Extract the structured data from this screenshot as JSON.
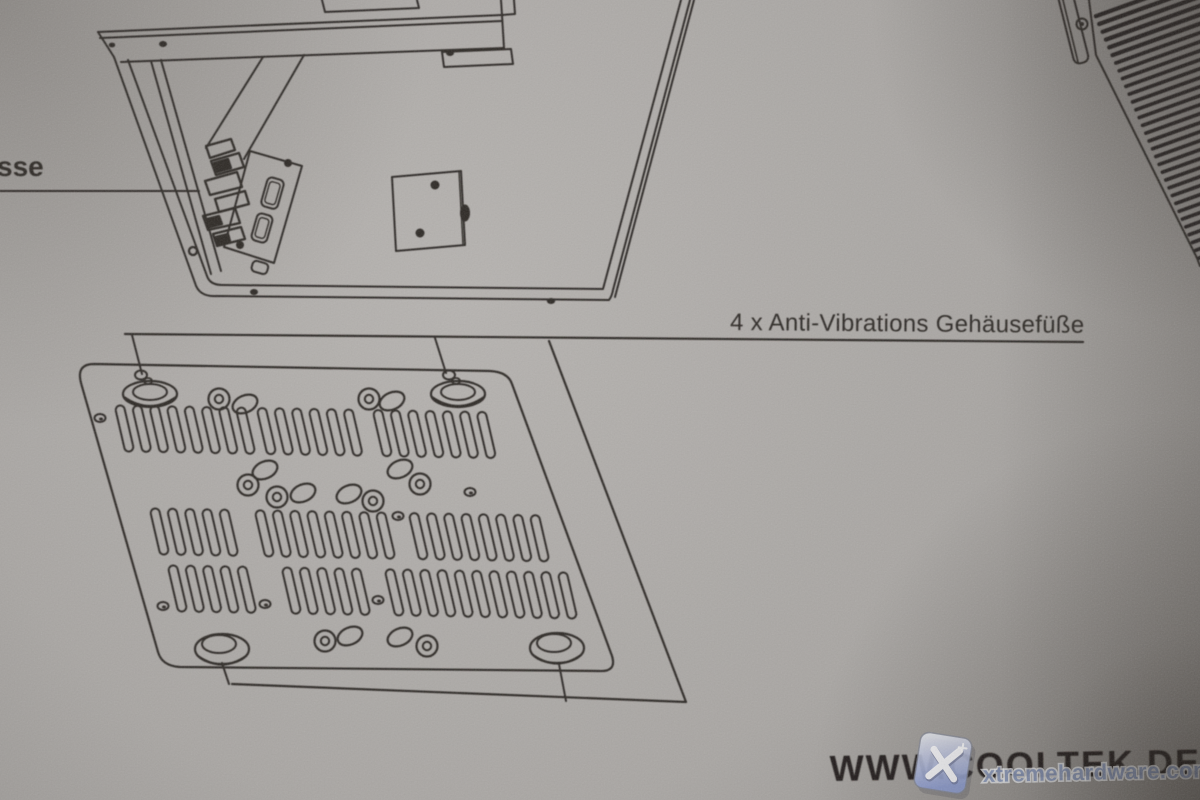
{
  "sheet": {
    "description": "photographed instruction sheet with technical line drawings",
    "labels": {
      "connector_label_fragment": "sse",
      "feet_label": "4 x Anti-Vibrations Gehäusefüße"
    },
    "branding": {
      "website": "WWW.COOLTEK.DE"
    },
    "watermark": {
      "text": "xtremehardware.com",
      "badge_glyph": "X"
    }
  },
  "colors": {
    "paper": "#aba8a5",
    "paper_light": "#b6b3b0",
    "paper_dark": "#8d8a87",
    "ink": "#2e2a27",
    "watermark_blue": "#6d83b8",
    "badge_blue": "#8fa0d8"
  }
}
